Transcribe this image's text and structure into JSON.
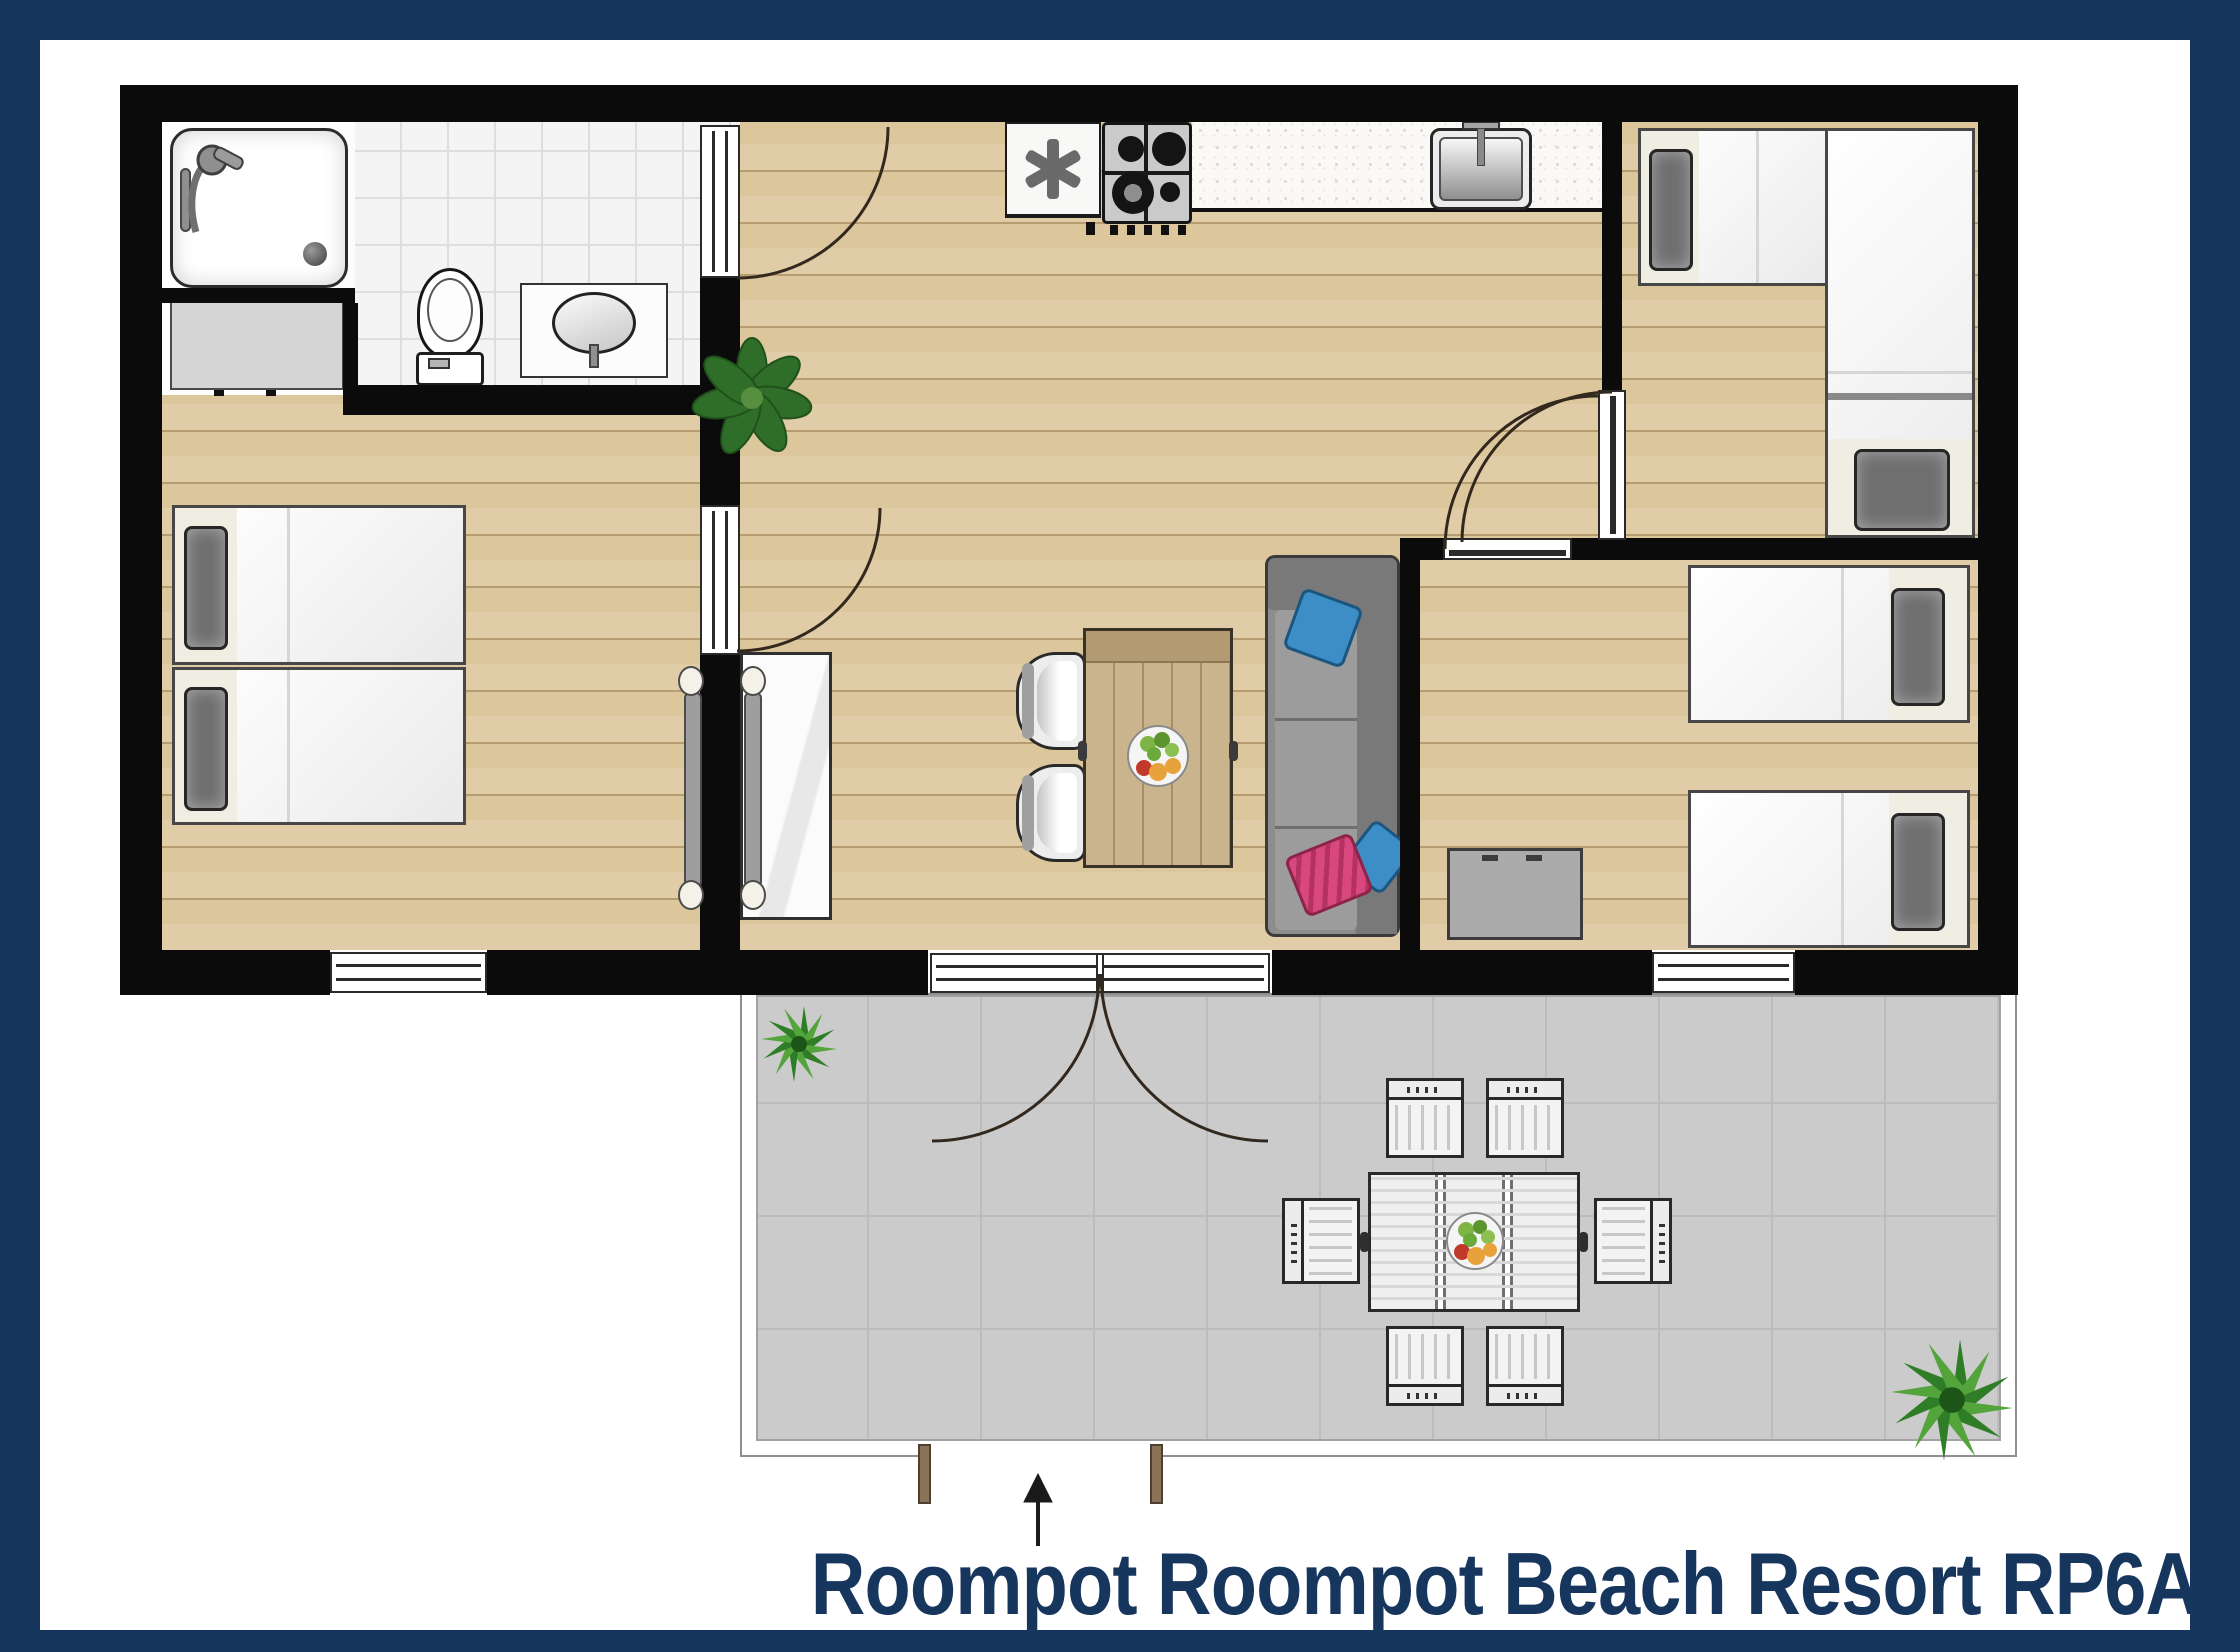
{
  "title": {
    "text": "Roompot Roompot Beach Resort RP6A",
    "color": "#17365D"
  },
  "frame": {
    "color": "#17365D"
  },
  "palette": {
    "wall_black": "#0b0b0b",
    "wood_floor": "#dcc69c",
    "bathroom_tile": "#f4f4f4",
    "terrace_gray": "#cbcbcb",
    "kitchen_counter": "#faf9f6",
    "couch_gray": "#8d8d8d",
    "pillow_blue": "#3d8ec6",
    "pillow_pink": "#d8487e",
    "plant_green": "#2f7d27",
    "outdoor_furniture_white": "#f3f3f3",
    "title_navy": "#17365D"
  },
  "icons": {
    "fan_symbol": "✳",
    "entrance_arrow": "↑"
  }
}
